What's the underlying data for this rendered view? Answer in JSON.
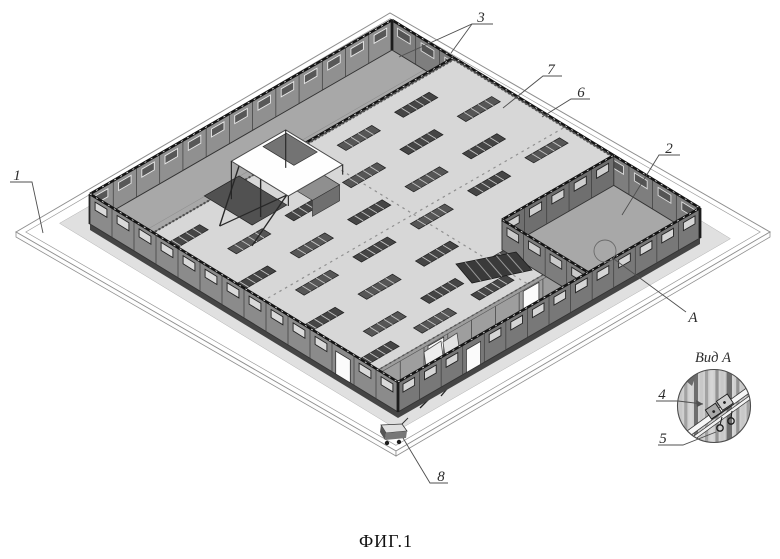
{
  "figure": {
    "caption": "ФИГ.1",
    "detail_view_title": "Вид A",
    "callouts": {
      "c1": "1",
      "c2": "2",
      "c3": "3",
      "c4": "4",
      "c5": "5",
      "c6": "6",
      "c7": "7",
      "c8": "8",
      "cA": "A"
    }
  }
}
